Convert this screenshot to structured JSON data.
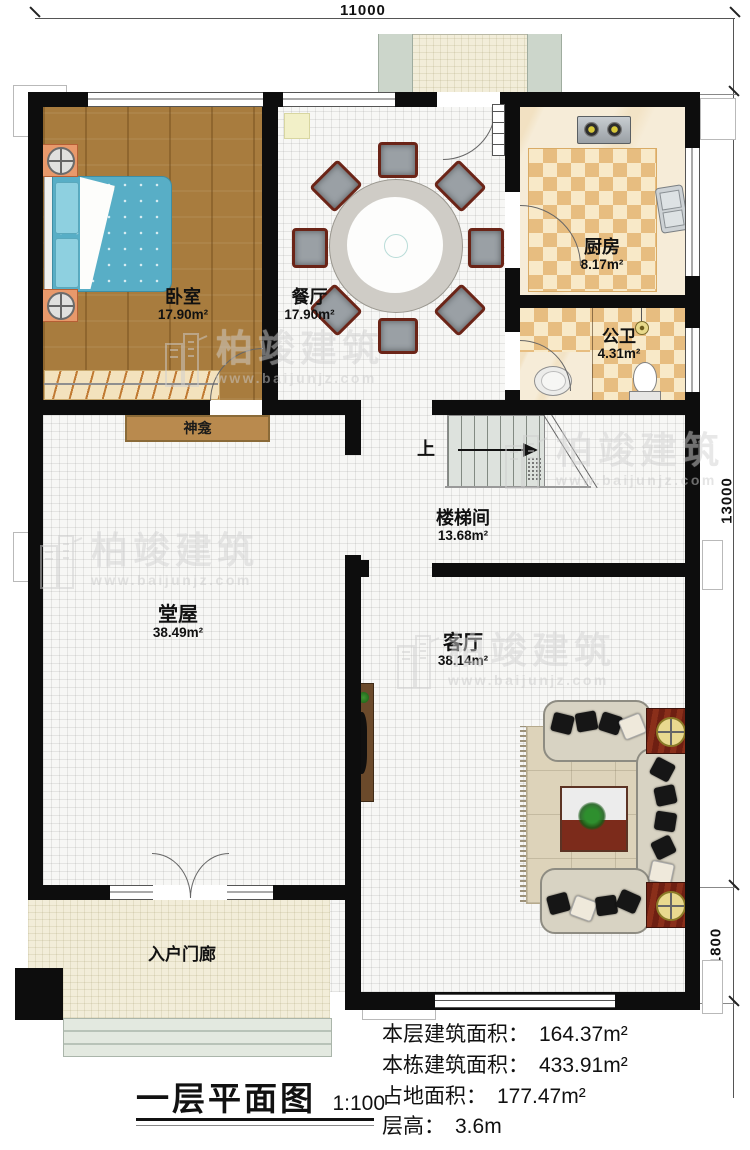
{
  "dimensions": {
    "top": "11000",
    "right_upper": "13000",
    "right_lower": "1800"
  },
  "rooms": {
    "bedroom": {
      "name": "卧室",
      "area": "17.90m²"
    },
    "dining": {
      "name": "餐厅",
      "area": "17.90m²"
    },
    "kitchen": {
      "name": "厨房",
      "area": "8.17m²"
    },
    "bath": {
      "name": "公卫",
      "area": "4.31m²"
    },
    "stair": {
      "name": "楼梯间",
      "area": "13.68m²"
    },
    "hall": {
      "name": "堂屋",
      "area": "38.49m²"
    },
    "living": {
      "name": "客厅",
      "area": "38.14m²"
    },
    "porch": {
      "name": "入户门廊"
    }
  },
  "labels": {
    "shrine": "神龛",
    "up": "上"
  },
  "watermark": {
    "brand": "柏竣建筑",
    "url": "www.baijunjz.com"
  },
  "title": {
    "text": "一层平面图",
    "scale": "1:100"
  },
  "stats": [
    {
      "label": "本层建筑面积：",
      "value": "164.37m²"
    },
    {
      "label": "本栋建筑面积：",
      "value": "433.91m²"
    },
    {
      "label": "占地面积：",
      "value": "177.47m²"
    },
    {
      "label": "层高：",
      "value": "3.6m"
    }
  ]
}
